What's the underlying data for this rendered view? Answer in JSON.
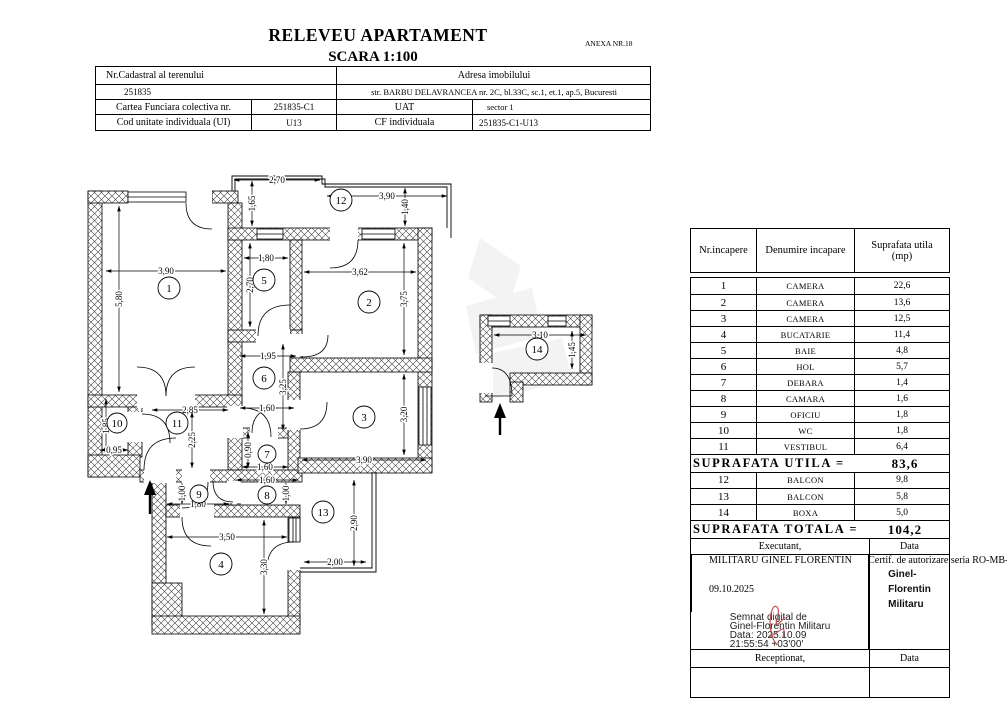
{
  "doc": {
    "title": "RELEVEU APARTAMENT",
    "subtitle": "SCARA 1:100",
    "annex": "ANEXA NR.18"
  },
  "cadastral": {
    "nr_cadastral_label": "Nr.Cadastral al terenului",
    "nr_cadastral_value": "251835",
    "adresa_label": "Adresa imobilului",
    "adresa_value": "str. BARBU DELAVRANCEA nr. 2C, bl.33C, sc.1, et.1, ap.5, Bucuresti",
    "cf_colectiva_label": "Cartea Funciara colectiva nr.",
    "cf_colectiva_value": "251835-C1",
    "uat_label": "UAT",
    "uat_value": "sector 1",
    "cod_ui_label": "Cod unitate individuala (UI)",
    "cod_ui_value": "U13",
    "cf_individuala_label": "CF individuala",
    "cf_individuala_value": "251835-C1-U13"
  },
  "rooms_table": {
    "header_nr": "Nr.incapere",
    "header_denumire": "Denumire incapare",
    "header_suprafata": "Suprafata utila",
    "header_mp": "(mp)",
    "rows_main": [
      [
        "1",
        "CAMERA",
        "22,6"
      ],
      [
        "2",
        "CAMERA",
        "13,6"
      ],
      [
        "3",
        "CAMERA",
        "12,5"
      ],
      [
        "4",
        "BUCATARIE",
        "11,4"
      ],
      [
        "5",
        "BAIE",
        "4,8"
      ],
      [
        "6",
        "HOL",
        "5,7"
      ],
      [
        "7",
        "DEBARA",
        "1,4"
      ],
      [
        "8",
        "CAMARA",
        "1,6"
      ],
      [
        "9",
        "OFICIU",
        "1,8"
      ],
      [
        "10",
        "WC",
        "1,8"
      ],
      [
        "11",
        "VESTIBUL",
        "6,4"
      ]
    ],
    "utila_label": "SUPRAFATA UTILA =",
    "utila_value": "83,6",
    "rows_annex": [
      [
        "12",
        "BALCON",
        "9,8"
      ],
      [
        "13",
        "BALCON",
        "5,8"
      ],
      [
        "14",
        "BOXA",
        "5,0"
      ]
    ],
    "totala_label": "SUPRAFATA TOTALA =",
    "totala_value": "104,2"
  },
  "footer": {
    "executant_label": "Executant,",
    "data_label": "Data",
    "executant_name": "MILITARU GINEL FLORENTIN",
    "executant_cert": "Certif. de autorizare seria RO-MB-F,nr.0031",
    "date_value": "09.10.2025",
    "signature_name_lines": [
      "Ginel-",
      "Florentin",
      "Militaru"
    ],
    "signature_note_lines": [
      "Semnat digital de",
      "Ginel-Florentin Militaru",
      "Data: 2025.10.09",
      "21:55:54 +03'00'"
    ],
    "receptionat_label": "Receptionat,",
    "data_label2": "Data"
  },
  "plan": {
    "room_labels": [
      {
        "n": "1",
        "x": 169,
        "y": 288,
        "r": 11
      },
      {
        "n": "2",
        "x": 369,
        "y": 302,
        "r": 11
      },
      {
        "n": "3",
        "x": 364,
        "y": 417,
        "r": 11
      },
      {
        "n": "4",
        "x": 221,
        "y": 564,
        "r": 11
      },
      {
        "n": "5",
        "x": 264,
        "y": 280,
        "r": 11
      },
      {
        "n": "6",
        "x": 264,
        "y": 378,
        "r": 11
      },
      {
        "n": "7",
        "x": 267,
        "y": 454,
        "r": 9
      },
      {
        "n": "8",
        "x": 267,
        "y": 495,
        "r": 9
      },
      {
        "n": "9",
        "x": 199,
        "y": 494,
        "r": 9
      },
      {
        "n": "10",
        "x": 117,
        "y": 423,
        "r": 10
      },
      {
        "n": "11",
        "x": 177,
        "y": 423,
        "r": 11
      },
      {
        "n": "12",
        "x": 341,
        "y": 200,
        "r": 11
      },
      {
        "n": "13",
        "x": 323,
        "y": 512,
        "r": 11
      },
      {
        "n": "14",
        "x": 537,
        "y": 349,
        "r": 11
      }
    ],
    "dimensions": [
      {
        "t": "2,70",
        "x1": 234,
        "y1": 180,
        "x2": 320,
        "y2": 180
      },
      {
        "t": "1,65",
        "x1": 252,
        "y1": 181,
        "x2": 252,
        "y2": 226
      },
      {
        "t": "3,90",
        "x1": 327,
        "y1": 196,
        "x2": 447,
        "y2": 196
      },
      {
        "t": "1,40",
        "x1": 405,
        "y1": 188,
        "x2": 405,
        "y2": 226
      },
      {
        "t": "3,90",
        "x1": 106,
        "y1": 271,
        "x2": 226,
        "y2": 271
      },
      {
        "t": "5,80",
        "x1": 119,
        "y1": 206,
        "x2": 119,
        "y2": 392
      },
      {
        "t": "1,80",
        "x1": 244,
        "y1": 258,
        "x2": 288,
        "y2": 258
      },
      {
        "t": "2,70",
        "x1": 250,
        "y1": 243,
        "x2": 250,
        "y2": 327
      },
      {
        "t": "3,62",
        "x1": 304,
        "y1": 272,
        "x2": 416,
        "y2": 272
      },
      {
        "t": "3,75",
        "x1": 404,
        "y1": 243,
        "x2": 404,
        "y2": 355
      },
      {
        "t": "1,95",
        "x1": 240,
        "y1": 356,
        "x2": 296,
        "y2": 356
      },
      {
        "t": "3,25",
        "x1": 283,
        "y1": 344,
        "x2": 283,
        "y2": 430
      },
      {
        "t": "1,60",
        "x1": 240,
        "y1": 408,
        "x2": 294,
        "y2": 408
      },
      {
        "t": "3,90",
        "x1": 302,
        "y1": 460,
        "x2": 426,
        "y2": 460
      },
      {
        "t": "3,20",
        "x1": 404,
        "y1": 374,
        "x2": 404,
        "y2": 455
      },
      {
        "t": "1,85",
        "x1": 106,
        "y1": 399,
        "x2": 106,
        "y2": 453
      },
      {
        "t": "0,95",
        "x1": 100,
        "y1": 450,
        "x2": 128,
        "y2": 450
      },
      {
        "t": "2,85",
        "x1": 152,
        "y1": 410,
        "x2": 228,
        "y2": 410
      },
      {
        "t": "2,25",
        "x1": 192,
        "y1": 412,
        "x2": 192,
        "y2": 468
      },
      {
        "t": "0,90",
        "x1": 248,
        "y1": 432,
        "x2": 248,
        "y2": 468
      },
      {
        "t": "1,60",
        "x1": 242,
        "y1": 467,
        "x2": 288,
        "y2": 467
      },
      {
        "t": "1,60",
        "x1": 236,
        "y1": 480,
        "x2": 298,
        "y2": 480
      },
      {
        "t": "1,00",
        "x1": 286,
        "y1": 483,
        "x2": 286,
        "y2": 504
      },
      {
        "t": "1,00",
        "x1": 182,
        "y1": 483,
        "x2": 182,
        "y2": 504
      },
      {
        "t": "1,80",
        "x1": 167,
        "y1": 504,
        "x2": 229,
        "y2": 504
      },
      {
        "t": "3,50",
        "x1": 167,
        "y1": 537,
        "x2": 287,
        "y2": 537
      },
      {
        "t": "3,30",
        "x1": 264,
        "y1": 520,
        "x2": 264,
        "y2": 614
      },
      {
        "t": "2,90",
        "x1": 354,
        "y1": 480,
        "x2": 354,
        "y2": 566
      },
      {
        "t": "2,00",
        "x1": 304,
        "y1": 562,
        "x2": 366,
        "y2": 562
      },
      {
        "t": "3,10",
        "x1": 494,
        "y1": 335,
        "x2": 586,
        "y2": 335
      },
      {
        "t": "1,45",
        "x1": 572,
        "y1": 331,
        "x2": 572,
        "y2": 369
      }
    ],
    "entrance_arrows": [
      {
        "x": 150,
        "tip": 480,
        "tail": 514
      },
      {
        "x": 500,
        "tip": 403,
        "tail": 435
      }
    ]
  }
}
